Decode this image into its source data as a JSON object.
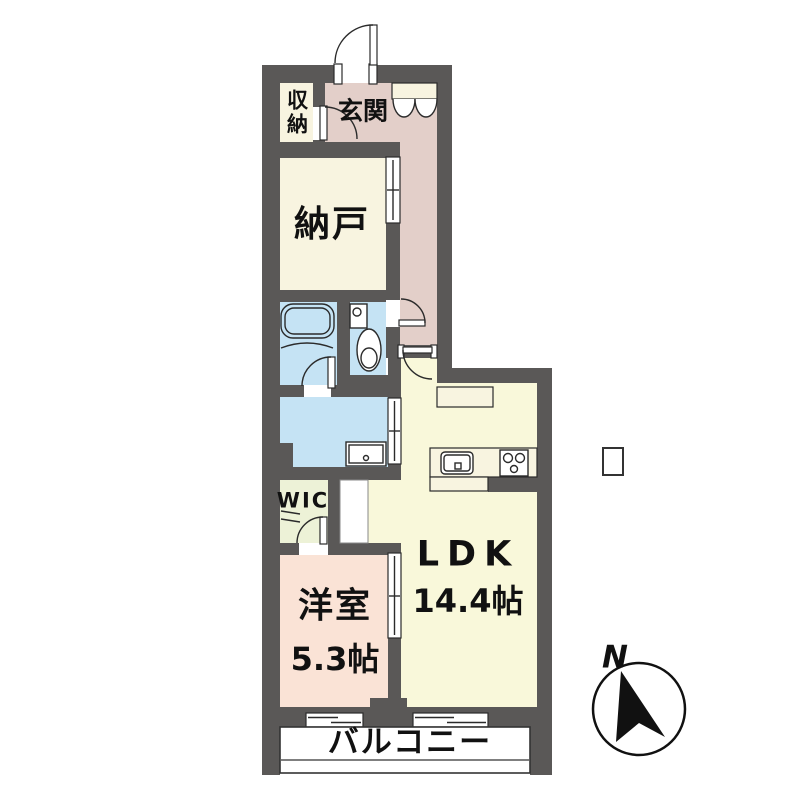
{
  "rooms": {
    "entrance": "玄関",
    "storage_upper": "収納",
    "storeroom": "納戸",
    "wic": "WIC",
    "western_room": {
      "name": "洋室",
      "size": "5.3帖"
    },
    "ldk": {
      "name": "LDK",
      "size": "14.4帖"
    },
    "balcony": "バルコニー"
  },
  "compass": {
    "north_label": "N"
  },
  "colors": {
    "wall": "#5a5857",
    "hall": "#e3cfc9",
    "closet": "#f8f4e0",
    "ldk": "#f9f8da",
    "bedroom": "#fae3d6",
    "water": "#c5e3f4",
    "wic": "#edf2d7"
  }
}
